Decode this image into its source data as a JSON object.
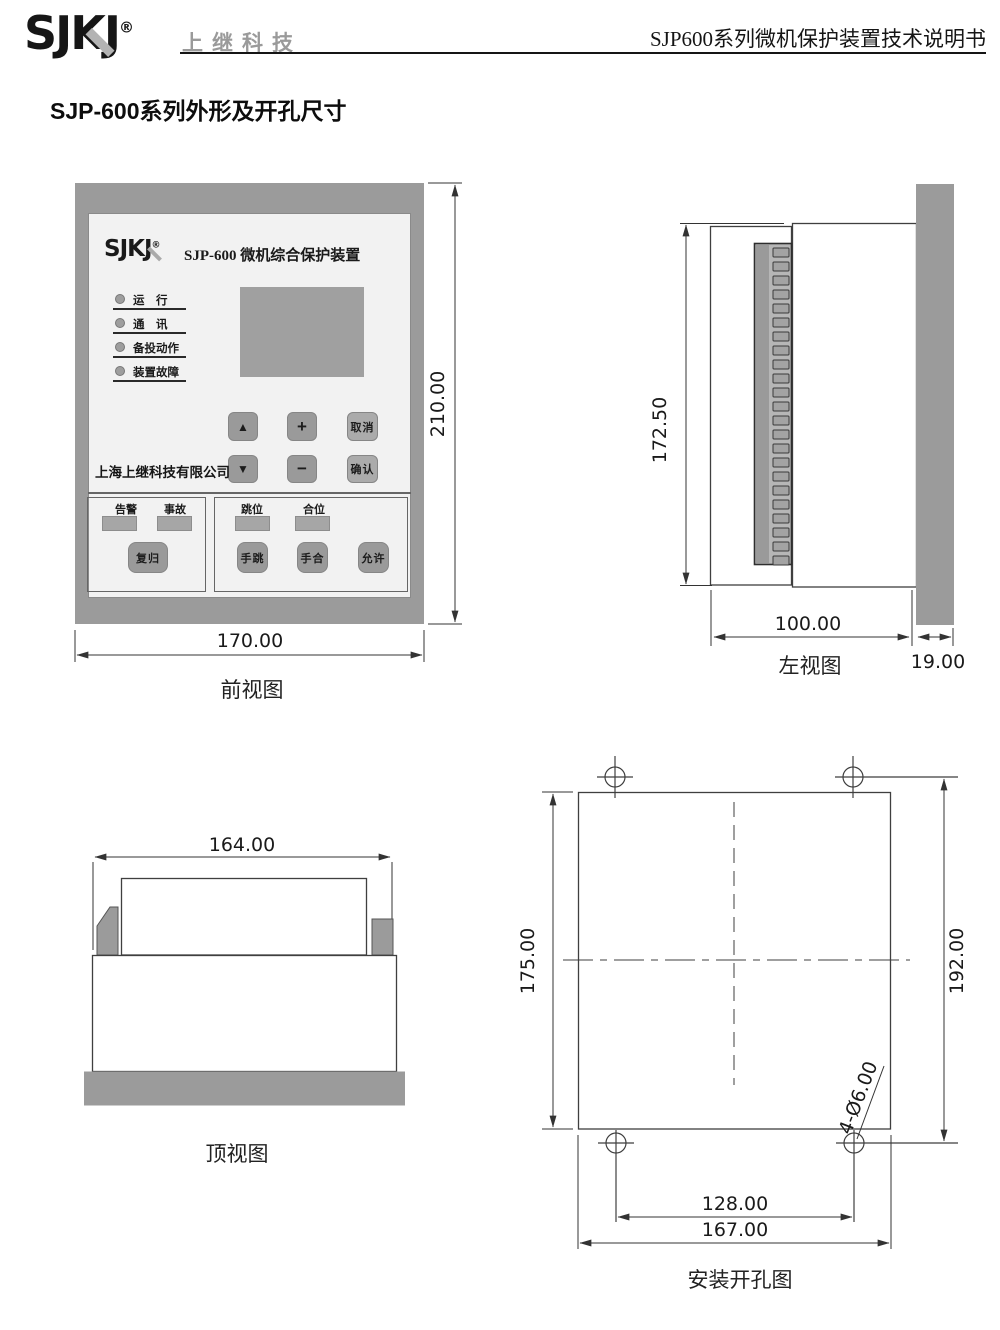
{
  "header": {
    "logo_text": "SJKJ",
    "registered_mark": "®",
    "brand_name": "上继科技",
    "doc_title": "SJP600系列微机保护装置技术说明书"
  },
  "page_title": "SJP-600系列外形及开孔尺寸",
  "front_view": {
    "caption": "前视图",
    "dim_width": "170.00",
    "dim_height": "210.00",
    "device": {
      "logo_text": "SJKJ",
      "registered_mark": "®",
      "model_title": "SJP-600 微机综合保护装置",
      "leds": [
        {
          "label": "运　行"
        },
        {
          "label": "通　讯"
        },
        {
          "label": "备投动作"
        },
        {
          "label": "装置故障"
        }
      ],
      "company_name": "上海上继科技有限公司",
      "keypad": {
        "up": "▲",
        "plus": "+",
        "cancel": "取消",
        "down": "▼",
        "minus": "−",
        "confirm": "确认"
      },
      "signal_panel": {
        "alarm_label": "告警",
        "fault_label": "事故",
        "reset_button": "复归"
      },
      "operate_panel": {
        "trip_label": "跳位",
        "close_label": "合位",
        "manual_trip_button": "手跳",
        "manual_close_button": "手合",
        "permit_button": "允许"
      }
    }
  },
  "left_view": {
    "caption": "左视图",
    "dim_height": "172.50",
    "dim_depth": "100.00",
    "dim_panel_thickness": "19.00",
    "terminal_count": 23
  },
  "top_view": {
    "caption": "顶视图",
    "dim_width": "164.00"
  },
  "install_view": {
    "caption": "安装开孔图",
    "dim_cutout_height": "175.00",
    "dim_hole_spacing_v": "192.00",
    "dim_hole_spacing_h": "128.00",
    "dim_cutout_width": "167.00",
    "hole_note": "4-Ø6.00"
  },
  "colors": {
    "line": "#3f3f3f",
    "dimension_line": "#333333",
    "gray_fill": "#9b9b9b",
    "panel_fill": "#f2f2f2",
    "lcd_fill": "#a0a0a0"
  }
}
